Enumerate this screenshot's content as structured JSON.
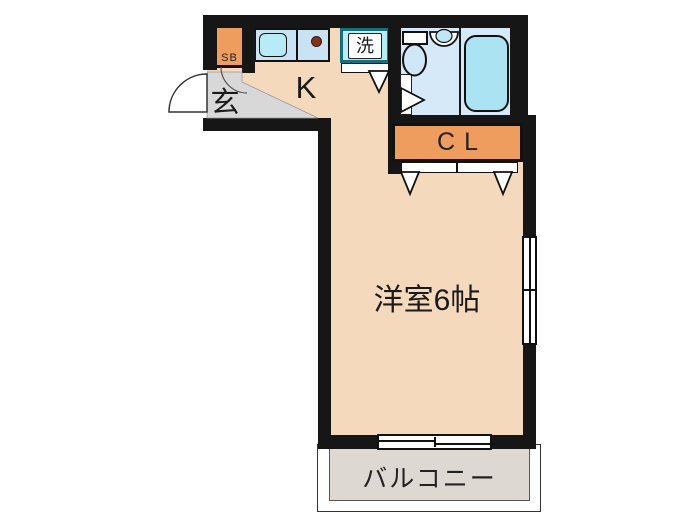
{
  "rooms": {
    "entrance": {
      "label": "玄"
    },
    "shoe_box": {
      "label": "SB"
    },
    "kitchen": {
      "label": "K"
    },
    "laundry": {
      "label": "洗"
    },
    "closet": {
      "label": "CL"
    },
    "main_room": {
      "label": "洋室6帖"
    },
    "balcony": {
      "label": "バルコニー"
    }
  },
  "colors": {
    "wall": "#161616",
    "floor_main": "#f5d9bc",
    "floor_genkan": "#d8d8d8",
    "floor_bath": "#d6e9f8",
    "counter": "#c9e2f4",
    "sink": "#b7ecf7",
    "tub": "#abe3f2",
    "washer_border": "#15707c",
    "burner": "#7e3518",
    "closet": "#ef9d5f",
    "balcony": "#ddd8d1",
    "toilet_bowl": "#cfe7f7"
  }
}
